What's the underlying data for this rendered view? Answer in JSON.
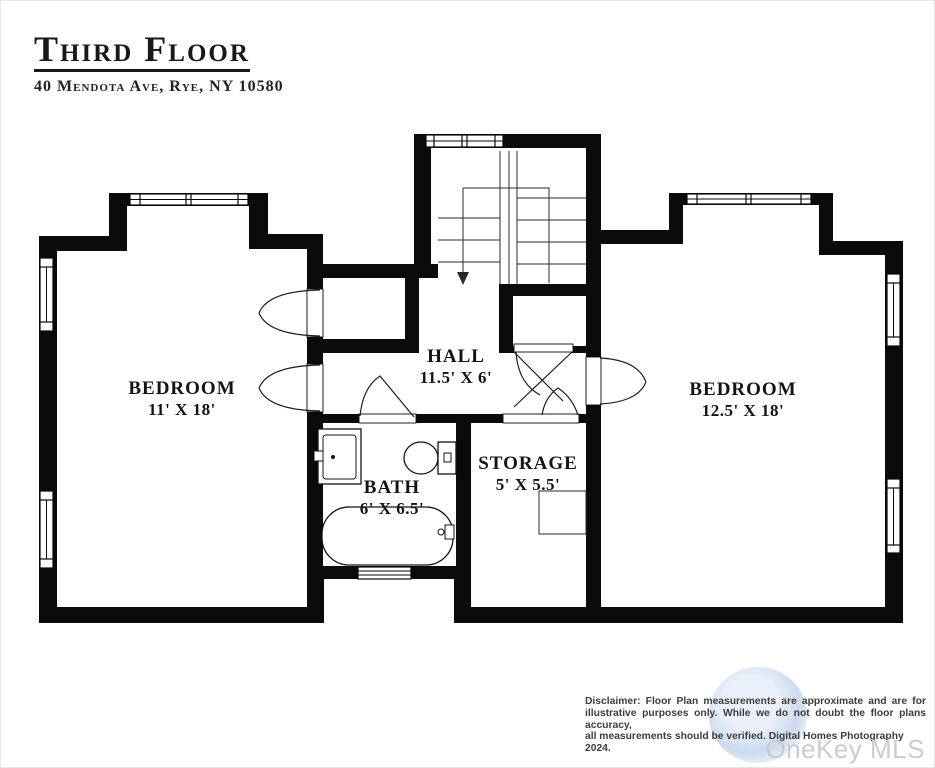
{
  "header": {
    "title": "Third Floor",
    "address": "40 Mendota Ave, Rye, NY 10580"
  },
  "rooms": [
    {
      "name": "BEDROOM",
      "dims": "11' X 18'"
    },
    {
      "name": "HALL",
      "dims": "11.5' X 6'"
    },
    {
      "name": "BATH",
      "dims": "6' X 6.5'"
    },
    {
      "name": "STORAGE",
      "dims": "5' X 5.5'"
    },
    {
      "name": "BEDROOM",
      "dims": "12.5' X 18'"
    }
  ],
  "disclaimer": {
    "line1": "Disclaimer: Floor Plan measurements are approximate and are for",
    "line2": "illustrative purposes only. While we do not doubt the floor plans accuracy,",
    "line3": "all measurements should be verified. Digital Homes Photography 2024."
  },
  "watermark": "OneKey MLS",
  "colors": {
    "wall": "#0a0a0a",
    "background": "#ffffff",
    "disclaimer_text": "#3d3d3d",
    "watermark_text": "#c7ccd3",
    "watermark_badge": "#a0bce0"
  }
}
